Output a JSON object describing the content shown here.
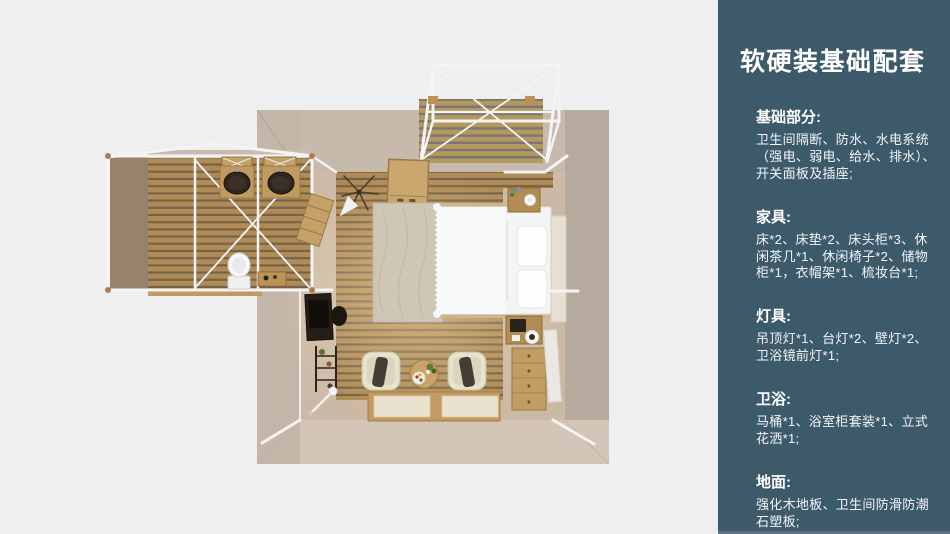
{
  "sidebar": {
    "title": "软硬装基础配套",
    "sections": [
      {
        "heading": "基础部分:",
        "body": "卫生间隔断、防水、水电系统（强电、弱电、给水、排水）、开关面板及插座;"
      },
      {
        "heading": "家具:",
        "body": "床*2、床垫*2、床头柜*3、休闲茶几*1、休闲椅子*2、储物柜*1，衣帽架*1、梳妆台*1;"
      },
      {
        "heading": "灯具:",
        "body": "吊顶灯*1、台灯*2、壁灯*2、卫浴镜前灯*1;"
      },
      {
        "heading": "卫浴:",
        "body": "马桶*1、浴室柜套装*1、立式花洒*1;"
      },
      {
        "heading": "地面:",
        "body": "强化木地板、卫生间防滑防潮石塑板;"
      }
    ],
    "colors": {
      "panel_bg": "#3d5a6b",
      "panel_text": "#ffffff",
      "canvas_bg": "#efefef"
    }
  }
}
